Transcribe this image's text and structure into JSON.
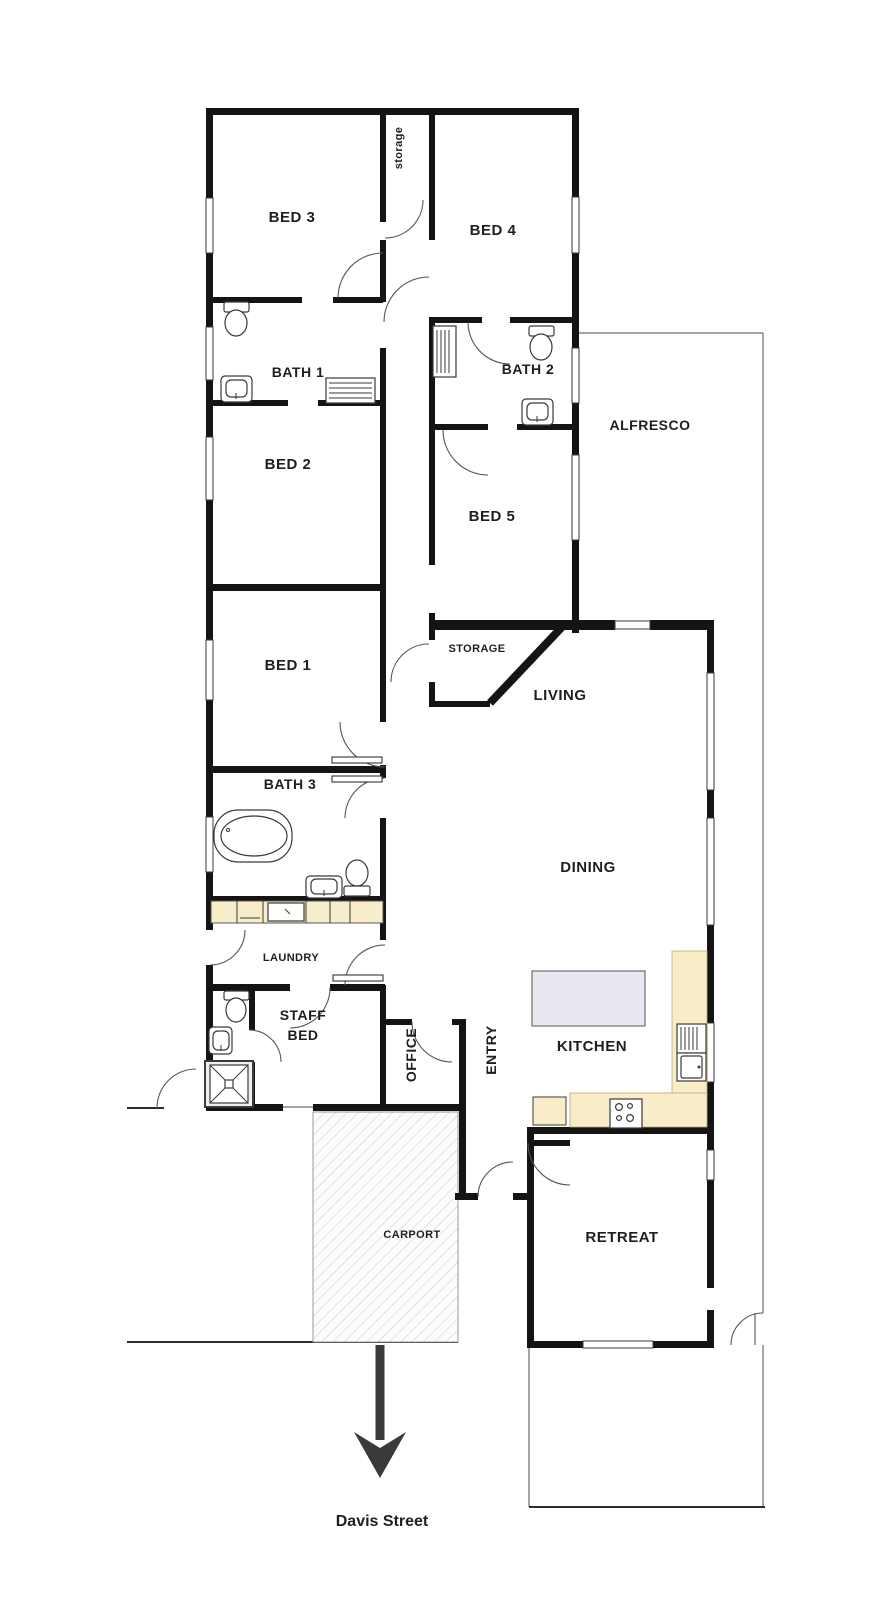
{
  "rooms": {
    "bed3": "BED 3",
    "storage_small": "storage",
    "bed4": "BED 4",
    "bath1": "BATH 1",
    "bath2": "BATH 2",
    "alfresco": "ALFRESCO",
    "bed2": "BED 2",
    "bed5": "BED 5",
    "bed1": "BED 1",
    "storage_mid": "STORAGE",
    "living": "LIVING",
    "bath3": "BATH 3",
    "dining": "DINING",
    "laundry": "LAUNDRY",
    "staff_bed_line1": "STAFF",
    "staff_bed_line2": "BED",
    "office": "OFFICE",
    "entry": "ENTRY",
    "kitchen": "KITCHEN",
    "carport": "CARPORT",
    "retreat": "RETREAT"
  },
  "street_label": "Davis Street",
  "colors": {
    "wall": "#141414",
    "bench": "#f9ecc9",
    "island": "#e8e8f1",
    "hatch_line": "#c9c9c9",
    "hatch_bg": "#fcfcfc"
  }
}
